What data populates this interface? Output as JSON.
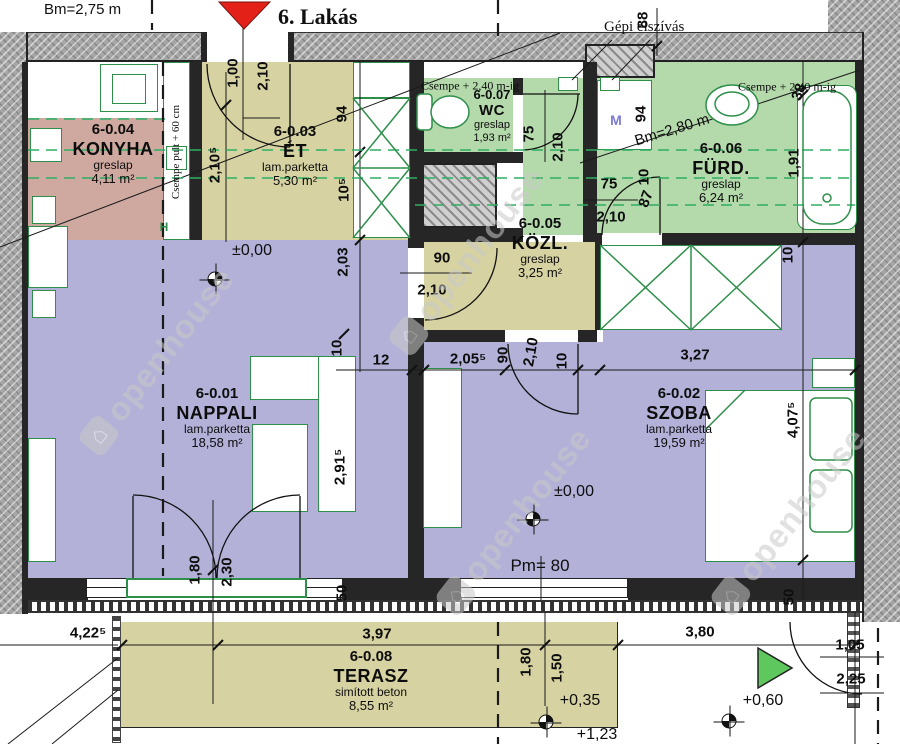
{
  "header": {
    "flat_title": "6. Lakás",
    "ceiling_height_top": "Bm=2,75 m",
    "vent_label": "Gépi elszívás"
  },
  "rooms": [
    {
      "id": "6-0.04",
      "name": "KONYHA",
      "floor": "greslap",
      "area": "4,11 m²"
    },
    {
      "id": "6-0.03",
      "name": "ÉT",
      "floor": "lam.parketta",
      "area": "5,30 m²"
    },
    {
      "id": "6-0.07",
      "name": "WC",
      "floor": "greslap",
      "area": "1,93 m²"
    },
    {
      "id": "6-0.06",
      "name": "FÜRD.",
      "floor": "greslap",
      "area": "6,24 m²"
    },
    {
      "id": "6-0.05",
      "name": "KÖZL.",
      "floor": "greslap",
      "area": "3,25 m²"
    },
    {
      "id": "6-0.01",
      "name": "NAPPALI",
      "floor": "lam.parketta",
      "area": "18,58 m²"
    },
    {
      "id": "6-0.02",
      "name": "SZOBA",
      "floor": "lam.parketta",
      "area": "19,59 m²"
    },
    {
      "id": "6-0.08",
      "name": "TERASZ",
      "floor": "simított beton",
      "area": "8,55 m²"
    }
  ],
  "annotations": [
    {
      "t": "Csempe + 2,40 m-ig",
      "x": 470,
      "y": 86,
      "r": 0,
      "cls": "serif"
    },
    {
      "t": "Csempe + 2,40 m-ig",
      "x": 787,
      "y": 87,
      "r": 0,
      "cls": "serif"
    },
    {
      "t": "Bm=2,80 m",
      "x": 672,
      "y": 130,
      "r": -17,
      "cls": "bm"
    },
    {
      "t": "Csempe pult + 60 cm",
      "x": 176,
      "y": 152,
      "r": -90,
      "cls": "pult"
    },
    {
      "t": "H",
      "x": 164,
      "y": 227,
      "r": 0,
      "cls": "hmark"
    },
    {
      "t": "M",
      "x": 616,
      "y": 120,
      "r": 0,
      "cls": "mmark"
    },
    {
      "t": "Pm= 80",
      "x": 540,
      "y": 566,
      "r": 0,
      "cls": "pm"
    },
    {
      "t": "+1,23",
      "x": 597,
      "y": 735,
      "r": 0,
      "cls": "lvl"
    }
  ],
  "levels": [
    {
      "t": "±0,00",
      "tx": 252,
      "ty": 251,
      "mx": 215,
      "my": 279
    },
    {
      "t": "±0,00",
      "tx": 574,
      "ty": 492,
      "mx": 533,
      "my": 519
    },
    {
      "t": "+0,35",
      "tx": 580,
      "ty": 701,
      "mx": 546,
      "my": 722
    },
    {
      "t": "+0,60",
      "tx": 763,
      "ty": 701,
      "mx": 729,
      "my": 721
    }
  ],
  "dimensions": [
    {
      "t": "1,00",
      "x": 233,
      "y": 73,
      "r": -90
    },
    {
      "t": "2,10",
      "x": 263,
      "y": 76,
      "r": -90
    },
    {
      "t": "2,10⁵",
      "x": 215,
      "y": 165,
      "r": -90
    },
    {
      "t": "94",
      "x": 342,
      "y": 114,
      "r": -90
    },
    {
      "t": "10⁵",
      "x": 344,
      "y": 190,
      "r": -90
    },
    {
      "t": "2,03",
      "x": 343,
      "y": 262,
      "r": -90
    },
    {
      "t": "10",
      "x": 337,
      "y": 348,
      "r": -90
    },
    {
      "t": "12",
      "x": 381,
      "y": 360,
      "r": 0
    },
    {
      "t": "2,05⁵",
      "x": 468,
      "y": 359,
      "r": 0
    },
    {
      "t": "90",
      "x": 503,
      "y": 355,
      "r": -90
    },
    {
      "t": "2,10",
      "x": 531,
      "y": 352,
      "r": -80
    },
    {
      "t": "10",
      "x": 562,
      "y": 361,
      "r": -90
    },
    {
      "t": "3,27",
      "x": 695,
      "y": 355,
      "r": 0
    },
    {
      "t": "88",
      "x": 643,
      "y": 20,
      "r": -90
    },
    {
      "t": "94",
      "x": 641,
      "y": 114,
      "r": -90
    },
    {
      "t": "10",
      "x": 644,
      "y": 177,
      "r": -90
    },
    {
      "t": "75",
      "x": 529,
      "y": 134,
      "r": -90
    },
    {
      "t": "2,10",
      "x": 558,
      "y": 147,
      "r": -90
    },
    {
      "t": "75",
      "x": 609,
      "y": 184,
      "r": 0
    },
    {
      "t": "87",
      "x": 646,
      "y": 199,
      "r": -70
    },
    {
      "t": "2,10",
      "x": 611,
      "y": 217,
      "r": 0
    },
    {
      "t": "90",
      "x": 442,
      "y": 258,
      "r": 0
    },
    {
      "t": "2,10",
      "x": 432,
      "y": 290,
      "r": 0
    },
    {
      "t": "38",
      "x": 799,
      "y": 92,
      "r": -70
    },
    {
      "t": "1,91",
      "x": 794,
      "y": 163,
      "r": -90
    },
    {
      "t": "10",
      "x": 788,
      "y": 255,
      "r": -90
    },
    {
      "t": "4,07⁵",
      "x": 793,
      "y": 420,
      "r": -90
    },
    {
      "t": "50",
      "x": 789,
      "y": 597,
      "r": -90
    },
    {
      "t": "50",
      "x": 342,
      "y": 593,
      "r": -90
    },
    {
      "t": "2,91⁵",
      "x": 340,
      "y": 467,
      "r": -90
    },
    {
      "t": "1,80",
      "x": 195,
      "y": 570,
      "r": -90
    },
    {
      "t": "2,30",
      "x": 227,
      "y": 572,
      "r": -90
    },
    {
      "t": "4,22⁵",
      "x": 88,
      "y": 633,
      "r": 0
    },
    {
      "t": "3,97",
      "x": 377,
      "y": 634,
      "r": 0
    },
    {
      "t": "3,80",
      "x": 700,
      "y": 632,
      "r": 0
    },
    {
      "t": "1,80",
      "x": 526,
      "y": 662,
      "r": -90
    },
    {
      "t": "1,50",
      "x": 557,
      "y": 668,
      "r": -90
    },
    {
      "t": "1,05",
      "x": 850,
      "y": 645,
      "r": 0
    },
    {
      "t": "2,25",
      "x": 851,
      "y": 679,
      "r": 0
    }
  ],
  "watermark": {
    "text": "openhouse"
  },
  "colors": {
    "floor_olive": "#d6d2a2",
    "floor_green": "#b4d9ab",
    "floor_purple": "#b3b1d8",
    "floor_pink": "#cfa9a0",
    "furniture_green": "#2e8f4a",
    "wall_dark": "#262626",
    "band_gray": "#a6a6a6",
    "entry_marker_red": "#e32119",
    "entry_arrow_green": "#5ec75e",
    "watermark_gray": "#c9c9c9",
    "washing_machine_blue": "#7b7bd6"
  }
}
